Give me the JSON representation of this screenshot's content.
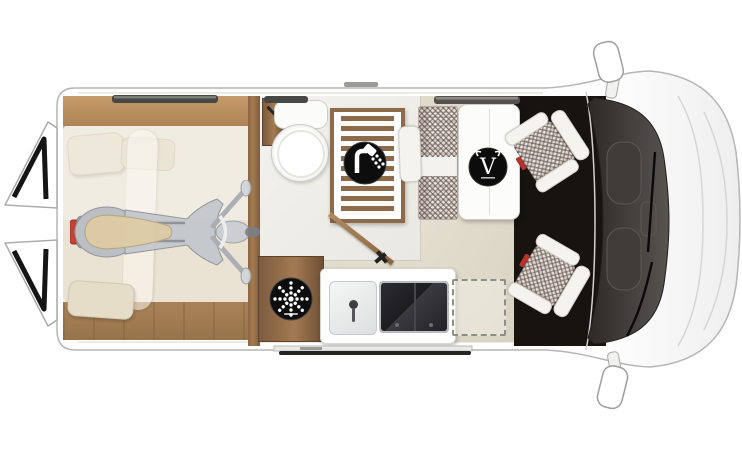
{
  "meta": {
    "title": "Campervan floor plan - top view",
    "canvas_width": 742,
    "canvas_height": 451
  },
  "brand": {
    "logo_letter": "V"
  },
  "vehicle": {
    "body_color": "#ffffff",
    "cab_floor_color": "#17140f",
    "living_floor_color": "#e0dbcc",
    "wood_color": "#a87e53",
    "upholstery_pattern": "houndstooth-check"
  },
  "rooms": {
    "rear_bedroom": {
      "name": "transverse-bed-with-scooter-storage",
      "items": [
        "double-bed",
        "pillows",
        "duvet",
        "scooter"
      ]
    },
    "bathroom": {
      "name": "bathroom",
      "items": [
        "toilet",
        "wall-cabinet",
        "shower-tray-slats",
        "shower-icon",
        "open-door"
      ]
    },
    "kitchen": {
      "name": "kitchen",
      "items": [
        "fridge-cabinet",
        "vent-fan-icon",
        "sink",
        "two-burner-hob",
        "optional-extension-dashed"
      ]
    },
    "dinette": {
      "name": "dinette",
      "items": [
        "bench-seat",
        "folding-table",
        "brand-logo",
        "swivel-seat-driver",
        "swivel-seat-passenger"
      ]
    },
    "cab": {
      "name": "driver-cab",
      "items": [
        "windshield",
        "wipers",
        "wing-mirror-top",
        "wing-mirror-bottom",
        "hood"
      ]
    },
    "exterior": {
      "items": [
        "rear-door-upper-open",
        "rear-door-lower-open",
        "sliding-door-rail",
        "wall-window-bed",
        "wall-window-bath",
        "wall-window-dinette",
        "awning-bar"
      ]
    }
  },
  "icons": {
    "shower": "shower-head-icon",
    "ventilation": "fan-dots-icon",
    "brand_logo": "v-ring-logo"
  }
}
